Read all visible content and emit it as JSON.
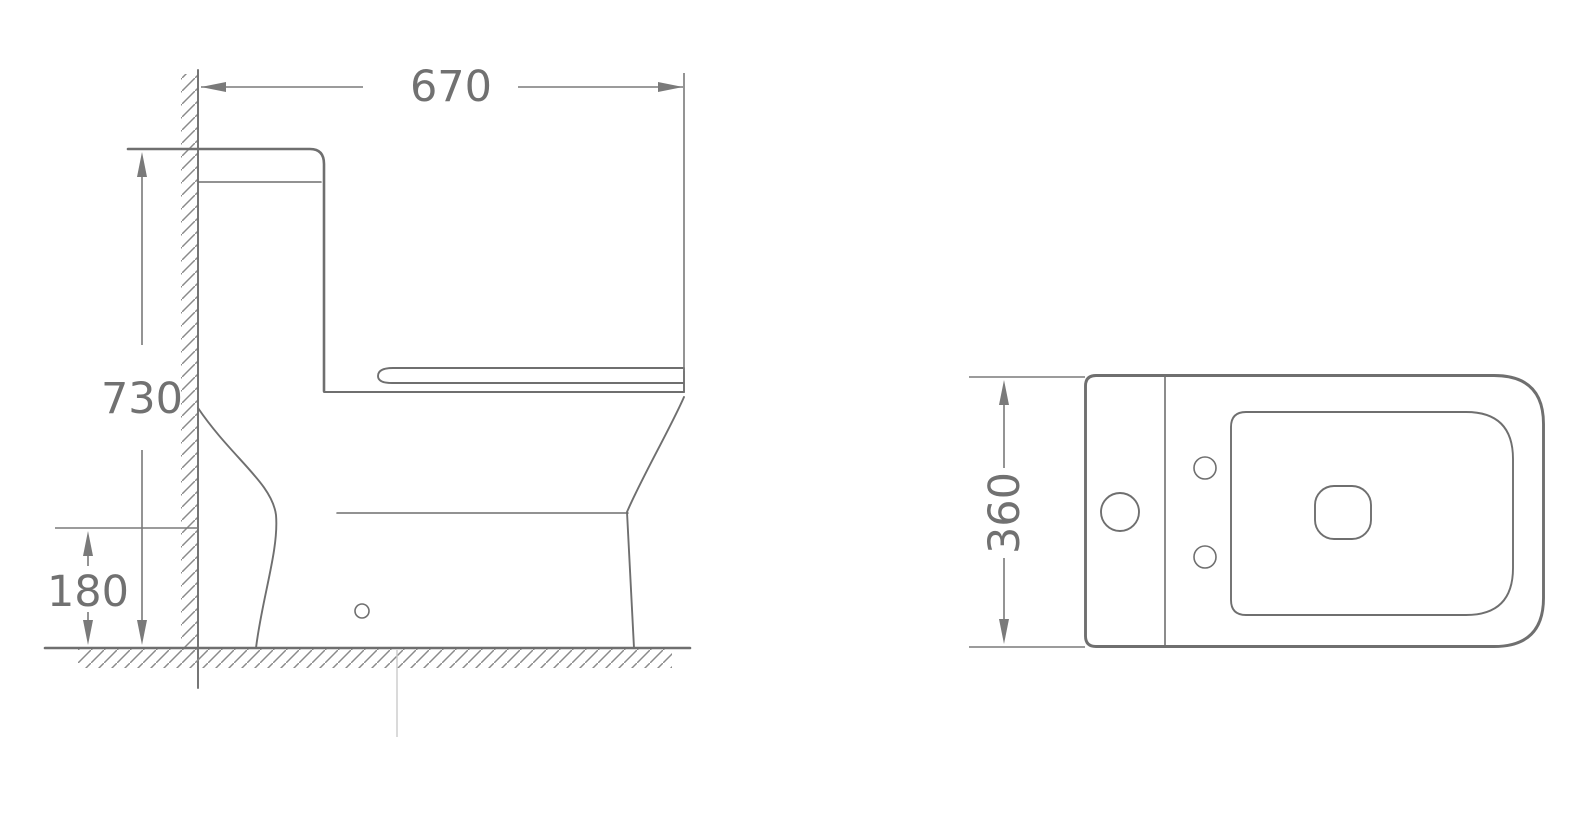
{
  "drawing": {
    "type": "technical-dimension-drawing",
    "subject": "one-piece toilet",
    "views": {
      "side": {
        "label": "side view",
        "dimensions": {
          "overall_depth": {
            "value": "670",
            "orientation": "horizontal"
          },
          "overall_height": {
            "value": "730",
            "orientation": "vertical"
          },
          "outlet_height": {
            "value": "180",
            "orientation": "vertical"
          }
        }
      },
      "top": {
        "label": "top view",
        "dimensions": {
          "overall_width": {
            "value": "360",
            "orientation": "vertical-rotated"
          }
        }
      }
    },
    "colors": {
      "background": "#ffffff",
      "outline": "#6f6f6f",
      "dimension_line": "#7a7a7a",
      "dimension_text": "#717171",
      "hatch": "#8a8a8a",
      "faint_mark": "#cbcbcb"
    }
  }
}
